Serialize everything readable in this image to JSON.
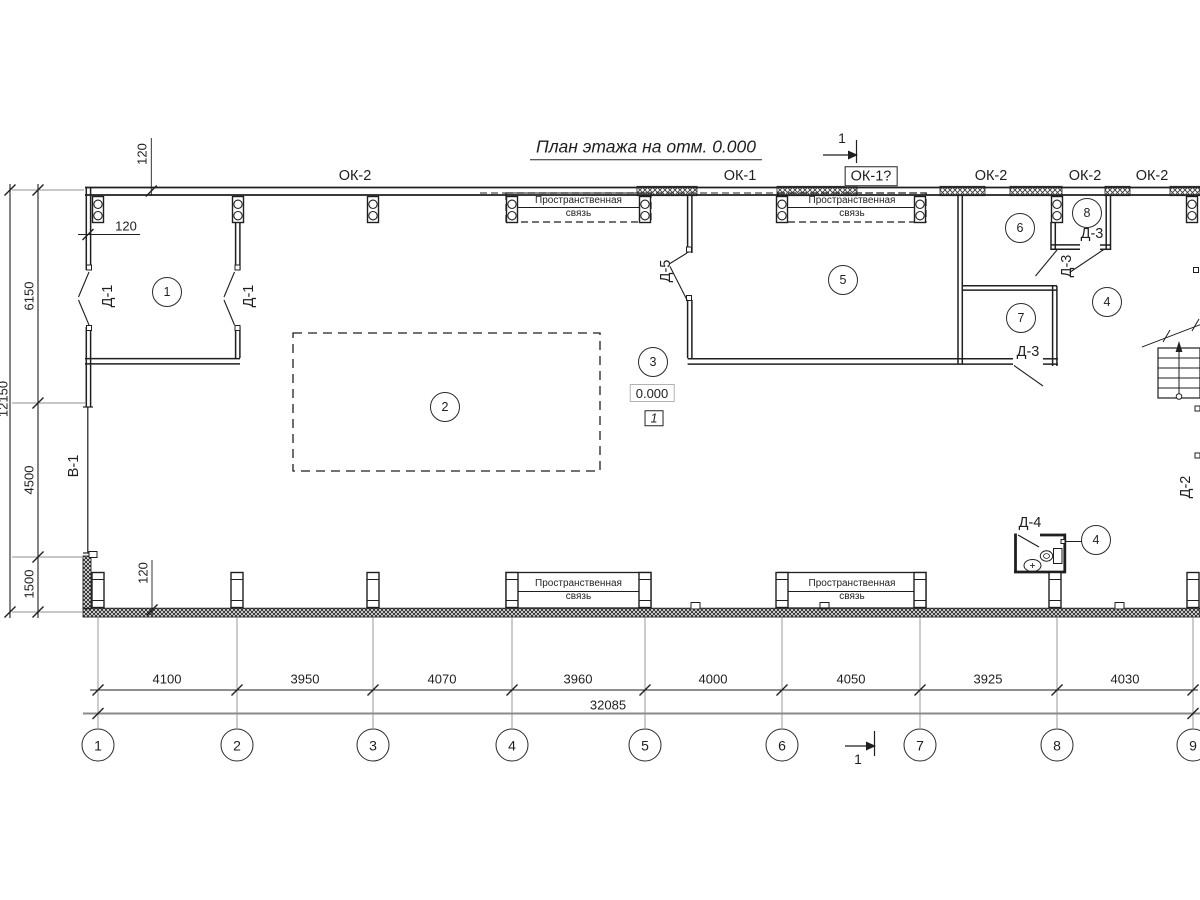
{
  "title": "План этажа на отм. 0.000",
  "section_marks": {
    "top": "1",
    "bottom": "1"
  },
  "window_labels": {
    "w1": "ОК-2",
    "w2": "ОК-1",
    "w3": "ОК-1?",
    "w4": "ОК-2",
    "w5": "ОК-2",
    "w6": "ОК-2"
  },
  "door_labels": {
    "d1a": "Д-1",
    "d1b": "Д-1",
    "d5": "Д-5",
    "d3a": "Д-3",
    "d3b": "Д-3",
    "d3c": "Д-3",
    "d4": "Д-4",
    "d2": "Д-2",
    "v1": "В-1"
  },
  "room_numbers": {
    "r1": "1",
    "r2": "2",
    "r3": "3",
    "r4": "4",
    "r4b": "4",
    "r5": "5",
    "r6": "6",
    "r7": "7",
    "r8": "8"
  },
  "spatial_tie": {
    "line1": "Пространственная",
    "line2": "связь"
  },
  "elevation": {
    "value": "0.000",
    "flag": "1"
  },
  "dims": {
    "bottom": [
      "4100",
      "3950",
      "4070",
      "3960",
      "4000",
      "4050",
      "3925",
      "4030"
    ],
    "total": "32085",
    "left": [
      "6150",
      "4500",
      "1500"
    ],
    "left_total": "12150",
    "wall1": "120",
    "wall2": "120",
    "wall3": "120"
  },
  "grid": [
    "1",
    "2",
    "3",
    "4",
    "5",
    "6",
    "7",
    "8",
    "9"
  ]
}
